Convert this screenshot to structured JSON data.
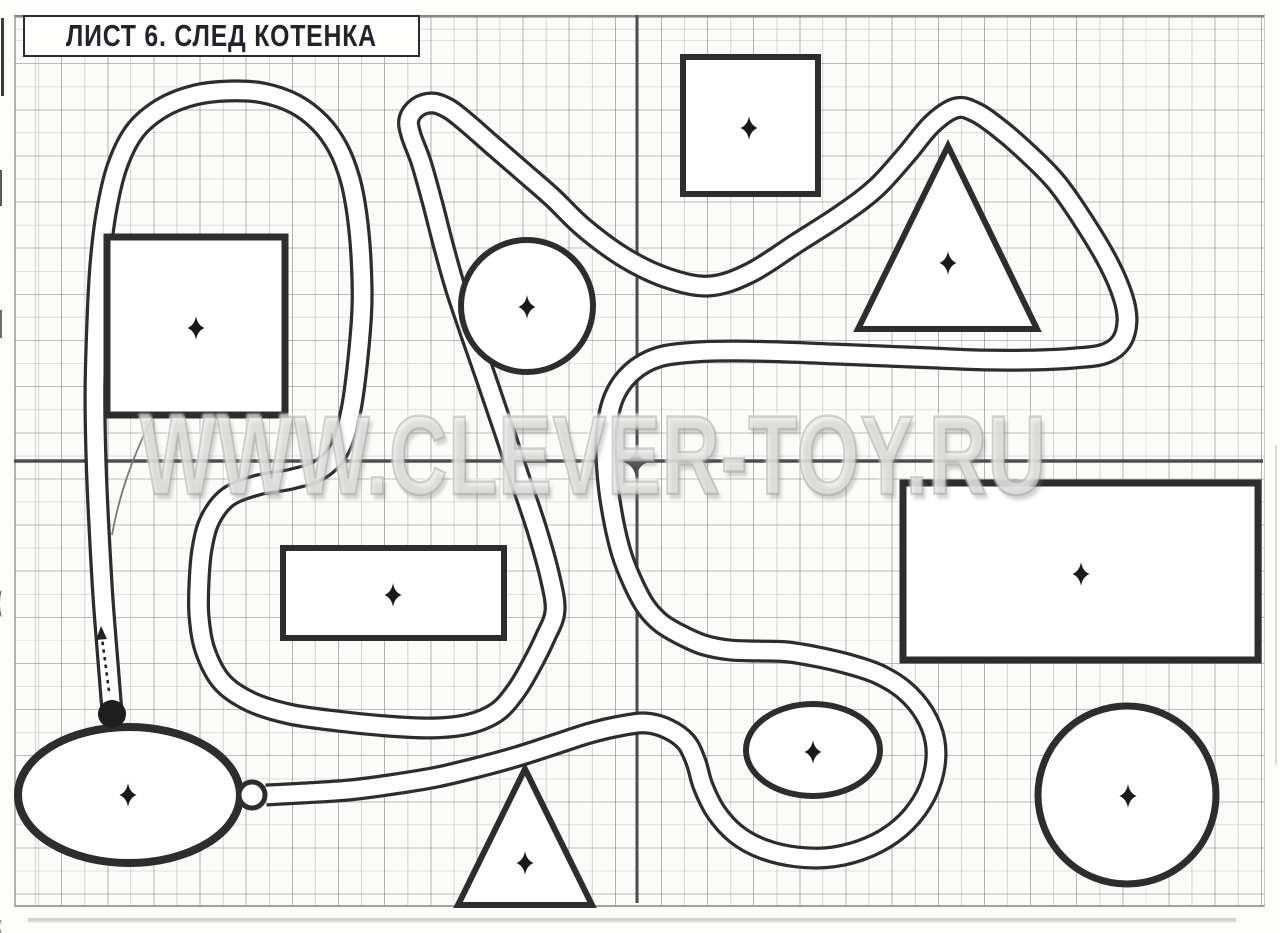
{
  "page": {
    "width": 1280,
    "height": 933
  },
  "title": {
    "text": "ЛИСТ 6. СЛЕД КОТЕНКА"
  },
  "watermark": {
    "text": "WWW.CLEVER-TOY.RU"
  },
  "colors": {
    "ink": "#2d2d2d",
    "paper": "#fbfbf9",
    "axis": "#4d4d4d",
    "road_fill": "#ffffff",
    "dot_fill": "#1e1e1e"
  },
  "grid": {
    "left": 14,
    "top": 15,
    "right": 1263,
    "bottom": 903,
    "cell": 23.07,
    "axis_x": 637,
    "axis_y": 461
  },
  "road": {
    "outer_width": 23,
    "inner_width": 16.5,
    "points": [
      [
        112,
        712
      ],
      [
        108,
        662
      ],
      [
        103,
        598
      ],
      [
        99,
        528
      ],
      [
        96,
        458
      ],
      [
        95,
        388
      ],
      [
        97,
        318
      ],
      [
        100,
        264
      ],
      [
        106,
        214
      ],
      [
        117,
        167
      ],
      [
        135,
        131
      ],
      [
        162,
        108
      ],
      [
        195,
        95
      ],
      [
        229,
        91
      ],
      [
        263,
        93
      ],
      [
        295,
        104
      ],
      [
        320,
        123
      ],
      [
        338,
        148
      ],
      [
        350,
        179
      ],
      [
        357,
        215
      ],
      [
        361,
        258
      ],
      [
        362,
        305
      ],
      [
        358,
        358
      ],
      [
        351,
        410
      ],
      [
        340,
        448
      ],
      [
        321,
        469
      ],
      [
        292,
        479
      ],
      [
        258,
        485
      ],
      [
        228,
        497
      ],
      [
        210,
        520
      ],
      [
        202,
        549
      ],
      [
        199,
        583
      ],
      [
        199,
        616
      ],
      [
        205,
        650
      ],
      [
        222,
        682
      ],
      [
        251,
        702
      ],
      [
        289,
        714
      ],
      [
        337,
        721
      ],
      [
        387,
        726
      ],
      [
        432,
        728
      ],
      [
        469,
        724
      ],
      [
        497,
        712
      ],
      [
        516,
        691
      ],
      [
        531,
        666
      ],
      [
        545,
        638
      ],
      [
        555,
        611
      ],
      [
        550,
        577
      ],
      [
        537,
        530
      ],
      [
        521,
        482
      ],
      [
        504,
        431
      ],
      [
        487,
        381
      ],
      [
        470,
        332
      ],
      [
        455,
        287
      ],
      [
        443,
        244
      ],
      [
        432,
        201
      ],
      [
        421,
        162
      ],
      [
        411,
        135
      ],
      [
        409,
        119
      ],
      [
        418,
        107
      ],
      [
        433,
        103
      ],
      [
        449,
        109
      ],
      [
        467,
        123
      ],
      [
        491,
        144
      ],
      [
        521,
        170
      ],
      [
        553,
        198
      ],
      [
        584,
        228
      ],
      [
        625,
        258
      ],
      [
        667,
        278
      ],
      [
        709,
        286
      ],
      [
        750,
        273
      ],
      [
        797,
        243
      ],
      [
        842,
        214
      ],
      [
        876,
        188
      ],
      [
        906,
        155
      ],
      [
        932,
        124
      ],
      [
        956,
        108
      ],
      [
        975,
        112
      ],
      [
        996,
        126
      ],
      [
        1022,
        148
      ],
      [
        1056,
        182
      ],
      [
        1086,
        225
      ],
      [
        1109,
        264
      ],
      [
        1123,
        297
      ],
      [
        1127,
        321
      ],
      [
        1121,
        342
      ],
      [
        1104,
        354
      ],
      [
        1075,
        358
      ],
      [
        1034,
        360
      ],
      [
        984,
        360
      ],
      [
        934,
        358
      ],
      [
        884,
        356
      ],
      [
        834,
        354
      ],
      [
        784,
        352
      ],
      [
        734,
        351
      ],
      [
        696,
        352
      ],
      [
        659,
        357
      ],
      [
        632,
        372
      ],
      [
        614,
        397
      ],
      [
        606,
        434
      ],
      [
        607,
        474
      ],
      [
        612,
        512
      ],
      [
        621,
        552
      ],
      [
        633,
        583
      ],
      [
        646,
        607
      ],
      [
        661,
        623
      ],
      [
        681,
        635
      ],
      [
        704,
        645
      ],
      [
        730,
        650
      ],
      [
        758,
        651
      ],
      [
        788,
        652
      ],
      [
        818,
        657
      ],
      [
        848,
        664
      ],
      [
        878,
        674
      ],
      [
        904,
        690
      ],
      [
        924,
        713
      ],
      [
        935,
        741
      ],
      [
        934,
        772
      ],
      [
        922,
        802
      ],
      [
        900,
        828
      ],
      [
        869,
        847
      ],
      [
        833,
        857
      ],
      [
        797,
        857
      ],
      [
        763,
        849
      ],
      [
        736,
        834
      ],
      [
        716,
        812
      ],
      [
        703,
        786
      ],
      [
        696,
        762
      ],
      [
        686,
        742
      ],
      [
        668,
        729
      ],
      [
        646,
        723
      ],
      [
        620,
        726
      ],
      [
        590,
        733
      ],
      [
        556,
        744
      ],
      [
        519,
        756
      ],
      [
        479,
        767
      ],
      [
        437,
        777
      ],
      [
        395,
        784
      ],
      [
        349,
        790
      ],
      [
        303,
        793
      ],
      [
        266,
        795
      ]
    ]
  },
  "shapes": [
    {
      "type": "rect",
      "name": "top-square",
      "x": 683,
      "y": 57,
      "w": 135,
      "h": 137,
      "sw": 6,
      "cross": [
        749,
        128
      ]
    },
    {
      "type": "rect",
      "name": "left-square",
      "x": 107,
      "y": 237,
      "w": 178,
      "h": 178,
      "sw": 7,
      "cross": [
        196,
        328
      ]
    },
    {
      "type": "circle",
      "name": "upper-circle",
      "cx": 527,
      "cy": 306,
      "r": 66,
      "sw": 6,
      "cross": [
        527,
        307
      ]
    },
    {
      "type": "triangle",
      "name": "right-triangle",
      "pts": [
        [
          948,
          146
        ],
        [
          1037,
          329
        ],
        [
          858,
          329
        ]
      ],
      "sw": 6,
      "cross": [
        948,
        263
      ]
    },
    {
      "type": "rect",
      "name": "center-rectangle",
      "x": 283,
      "y": 548,
      "w": 221,
      "h": 90,
      "sw": 6,
      "cross": [
        393,
        595
      ]
    },
    {
      "type": "rect",
      "name": "right-rectangle",
      "x": 903,
      "y": 483,
      "w": 355,
      "h": 177,
      "sw": 7,
      "cross": [
        1081,
        574
      ]
    },
    {
      "type": "ellipse",
      "name": "small-ellipse",
      "cx": 813,
      "cy": 750,
      "rx": 67,
      "ry": 46,
      "sw": 6,
      "cross": [
        813,
        752
      ]
    },
    {
      "type": "ellipse",
      "name": "big-ellipse",
      "cx": 129,
      "cy": 795,
      "rx": 111,
      "ry": 68,
      "sw": 8,
      "cross": [
        128,
        795
      ]
    },
    {
      "type": "triangle",
      "name": "bottom-triangle",
      "pts": [
        [
          525,
          769
        ],
        [
          592,
          905
        ],
        [
          458,
          905
        ]
      ],
      "sw": 6,
      "cross": [
        525,
        863
      ]
    },
    {
      "type": "circle",
      "name": "bottom-circle",
      "cx": 1127,
      "cy": 795,
      "r": 89,
      "sw": 7,
      "cross": [
        1128,
        796
      ]
    }
  ],
  "markers": {
    "start_dot": {
      "cx": 112,
      "cy": 714,
      "r": 14
    },
    "end_ring": {
      "cx": 252,
      "cy": 795,
      "r": 13,
      "sw": 5
    },
    "arrow": {
      "x1": 109,
      "y1": 691,
      "x2": 102,
      "y2": 638
    },
    "center_star": {
      "x": 636,
      "y": 462
    }
  },
  "crease": {
    "d": "M152,418 Q122,478 112,535"
  }
}
